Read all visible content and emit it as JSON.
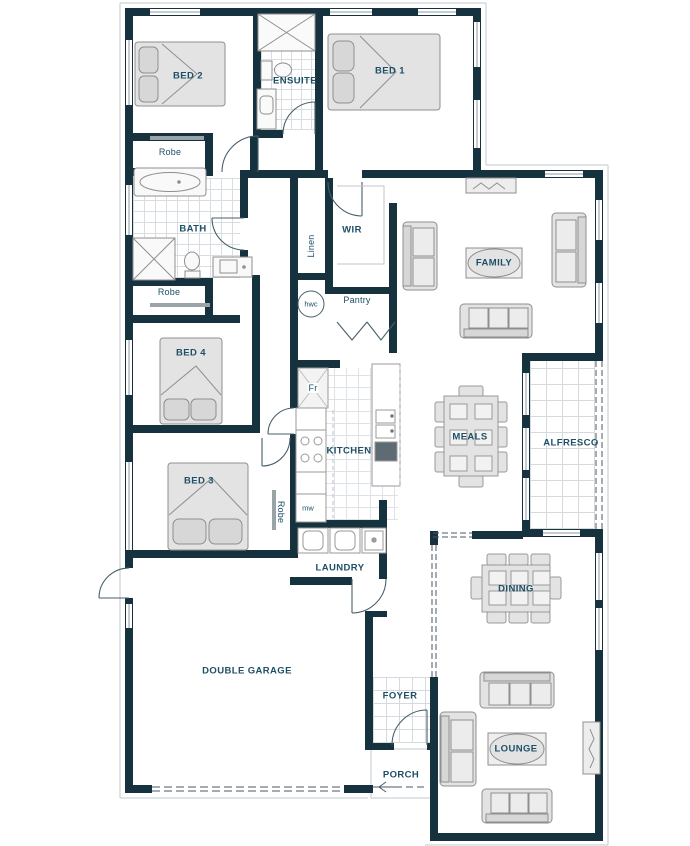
{
  "rooms": {
    "bed1": "BED 1",
    "bed2": "BED 2",
    "bed3": "BED 3",
    "bed4": "BED 4",
    "ensuite": "ENSUITE",
    "bath": "BATH",
    "wir": "WIR",
    "family": "FAMILY",
    "kitchen": "KITCHEN",
    "meals": "MEALS",
    "alfresco": "ALFRESCO",
    "dining": "DINING",
    "lounge": "LOUNGE",
    "laundry": "LAUNDRY",
    "garage": "DOUBLE GARAGE",
    "foyer": "FOYER",
    "porch": "PORCH"
  },
  "fixtures": {
    "robe": "Robe",
    "linen": "Linen",
    "pantry": "Pantry",
    "hwc": "hwc",
    "fridge": "Fr",
    "microwave": "mw"
  },
  "colors": {
    "wall": "#16323f",
    "label": "#1d4f66",
    "furniture_fill": "#e3e3e3",
    "furniture_stroke": "#8f8f8f",
    "tile_line": "#d6dbdf"
  }
}
